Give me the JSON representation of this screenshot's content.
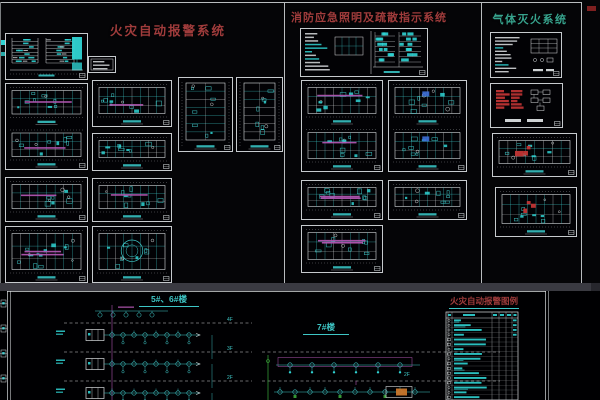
{
  "panels": {
    "fire_alarm": {
      "title": "火灾自动报警系统",
      "title_color": "#a03c3c"
    },
    "emergency_lighting": {
      "title": "消防应急照明及疏散指示系统",
      "title_color": "#a03c3c"
    },
    "gas_suppression": {
      "title": "气体灭火系统",
      "title_color": "#37a38d"
    }
  },
  "bottom_panel": {
    "riser_1": {
      "title": "5#、6#楼",
      "floor_labels": [
        "4F",
        "3F",
        "2F"
      ]
    },
    "riser_2": {
      "title": "7#楼",
      "floor_labels": [
        "2F"
      ]
    },
    "legend": {
      "title": "火灾自动报警图例",
      "row_count": 17
    }
  },
  "colors": {
    "background": "#050507",
    "cyan_line": "#3ec6c6",
    "cyan_fill": "#2fd3d3",
    "label_cyan": "#35b8b8",
    "white_line": "#d8dcde",
    "dim_line": "#9fa3a6",
    "magenta": "#b055b0",
    "red": "#c13434",
    "green": "#3aa63a",
    "orange": "#c8762b",
    "title_red": "#a03c3c",
    "title_teal": "#37a38d"
  }
}
